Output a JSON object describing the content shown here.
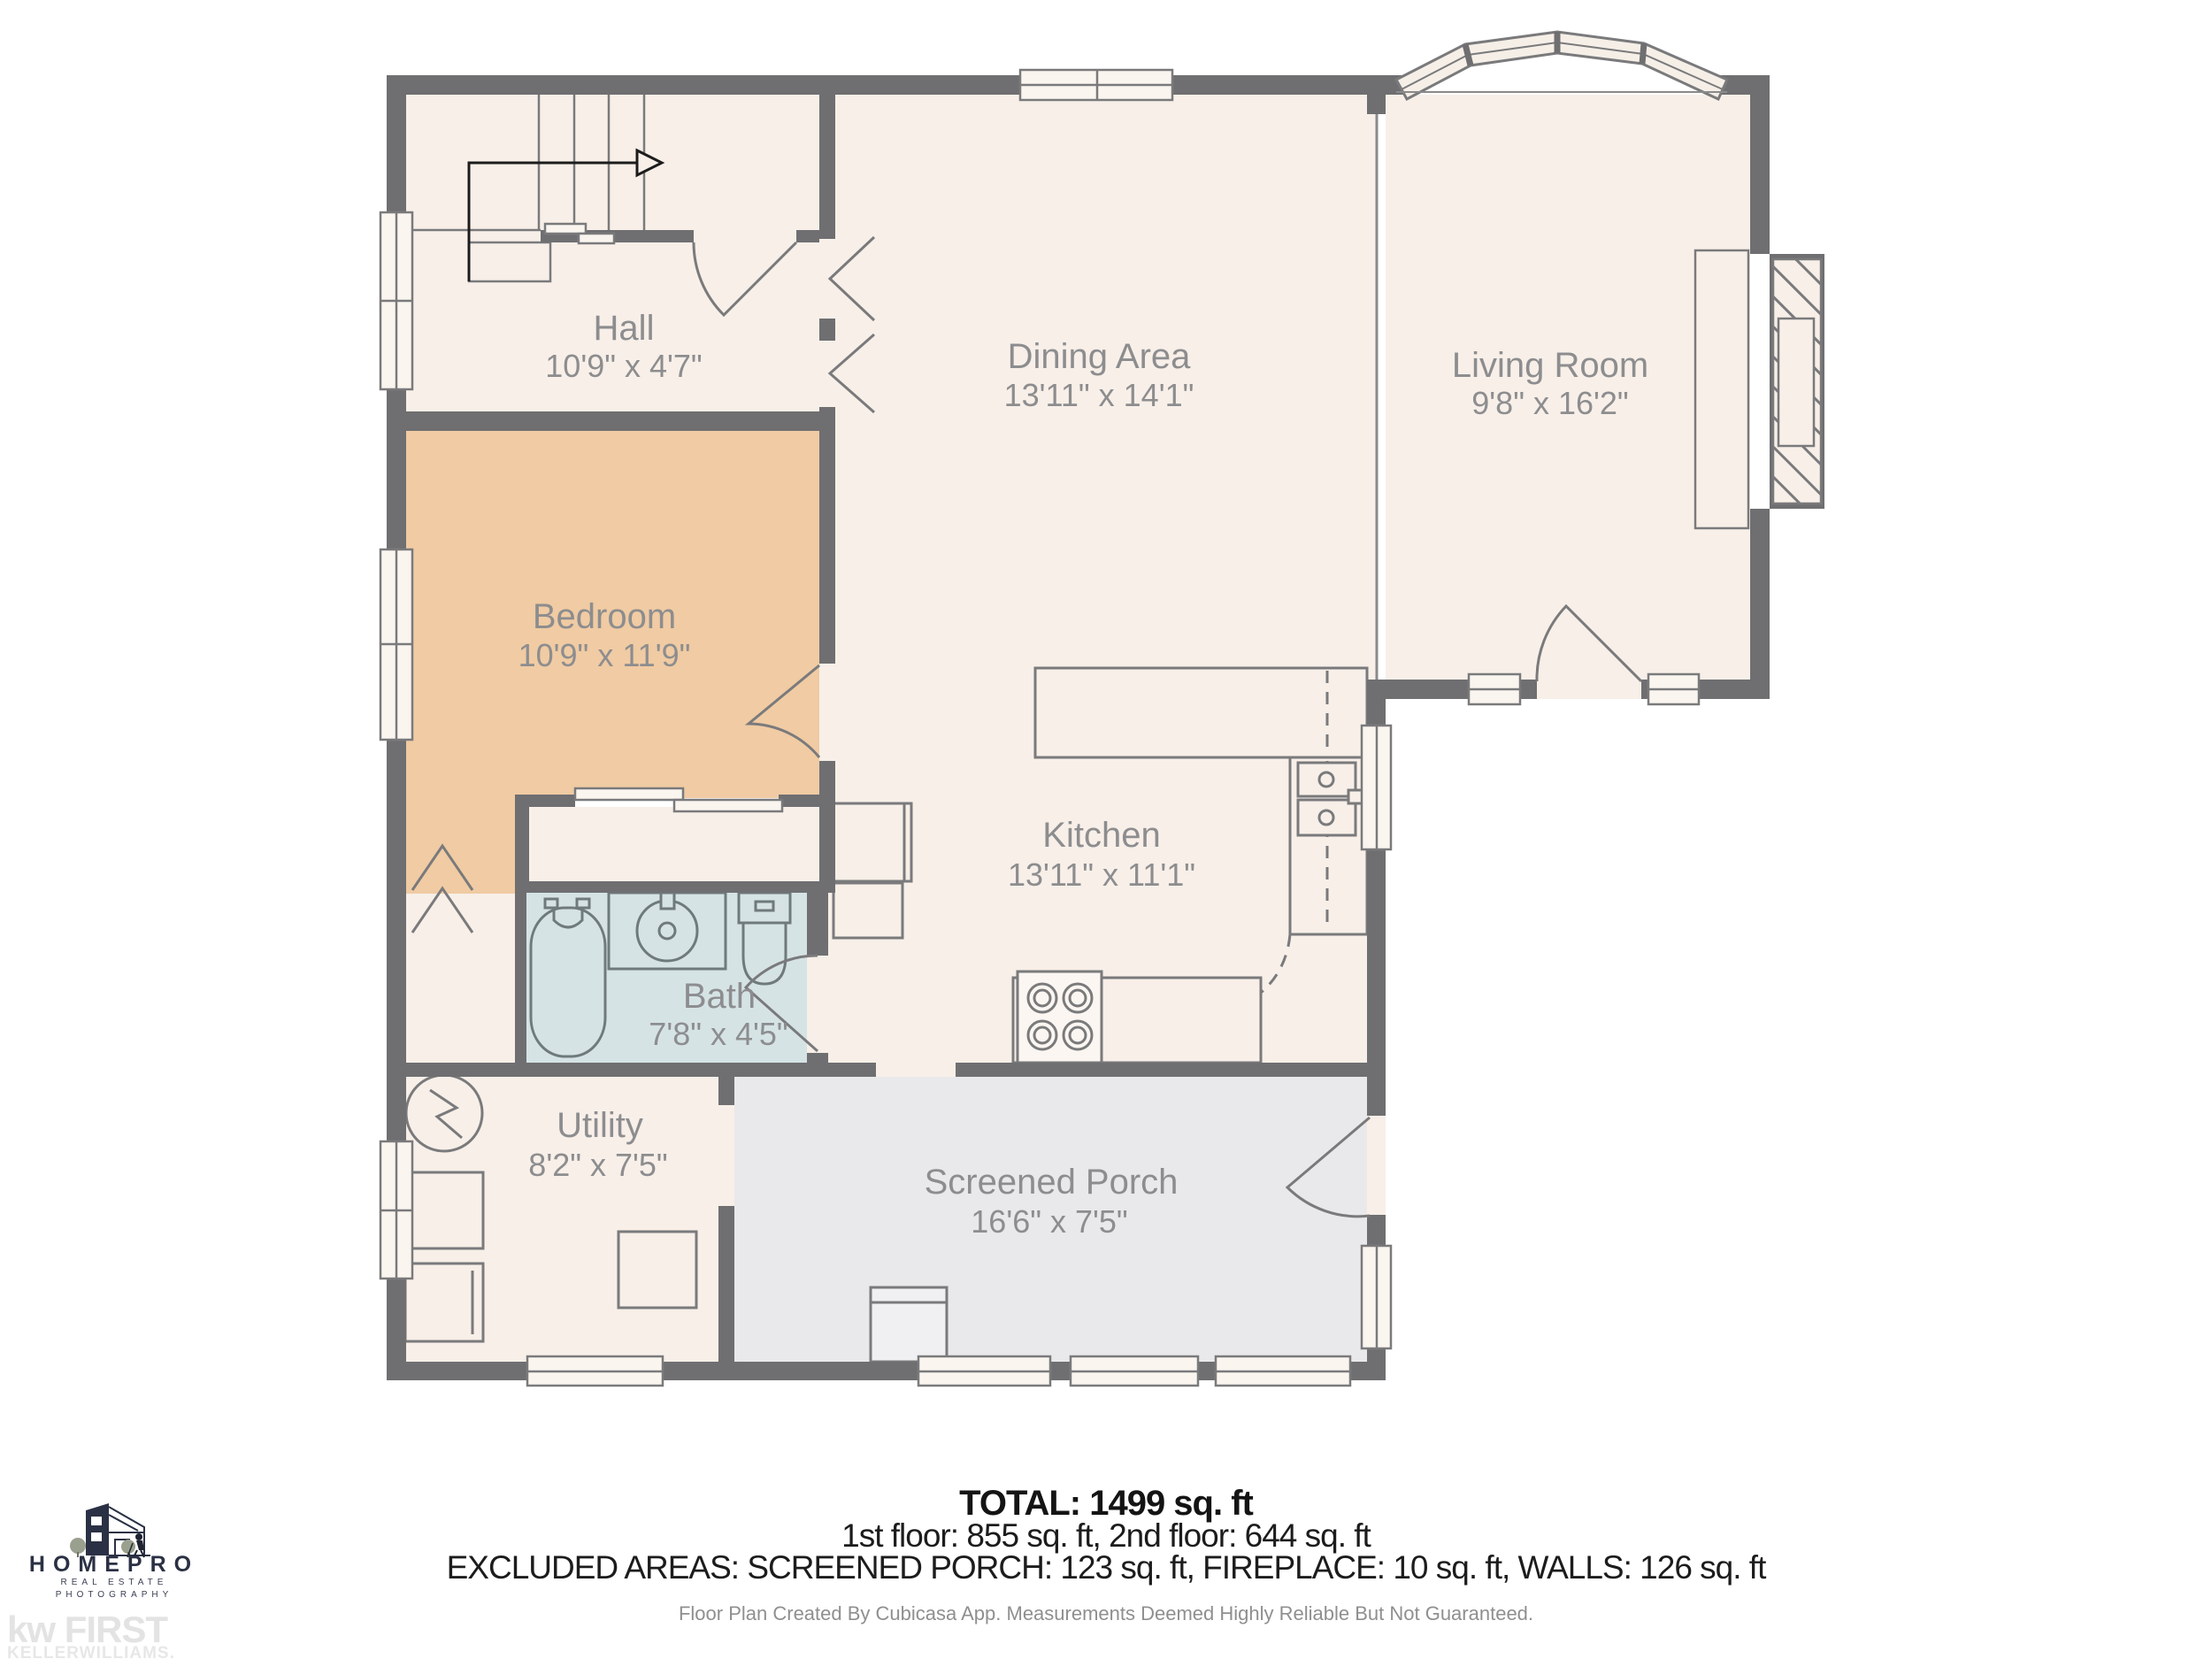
{
  "plan": {
    "rooms": [
      {
        "name": "Hall",
        "dims": "10'9\" x 4'7\""
      },
      {
        "name": "Dining Area",
        "dims": "13'11\" x 14'1\""
      },
      {
        "name": "Living Room",
        "dims": "9'8\" x 16'2\""
      },
      {
        "name": "Bedroom",
        "dims": "10'9\" x 11'9\""
      },
      {
        "name": "Kitchen",
        "dims": "13'11\" x 11'1\""
      },
      {
        "name": "Bath",
        "dims": "7'8\" x 4'5\""
      },
      {
        "name": "Utility",
        "dims": "8'2\" x 7'5\""
      },
      {
        "name": "Screened Porch",
        "dims": "16'6\" x 7'5\""
      }
    ],
    "summary": {
      "total": "TOTAL: 1499 sq. ft",
      "floors": "1st floor: 855 sq. ft, 2nd floor: 644 sq. ft",
      "excluded": "EXCLUDED AREAS: SCREENED PORCH: 123 sq. ft, FIREPLACE: 10 sq. ft, WALLS: 126 sq. ft"
    },
    "footnote": "Floor Plan Created By Cubicasa App. Measurements Deemed Highly Reliable But Not Guaranteed.",
    "logos": {
      "homepro": {
        "name": "HOMEPRO",
        "line1": "REAL ESTATE",
        "line2": "PHOTOGRAPHY"
      },
      "kw": {
        "main": "kw FIRST",
        "sub": "KELLERWILLIAMS."
      }
    },
    "colors": {
      "wall": "#6f6f71",
      "floor": "#f7efe8",
      "bedroom": "#f0cba3",
      "bath": "#d5e3e5",
      "porch": "#e9e9eb",
      "label": "#8d8d8f",
      "line": "#7a7a7c"
    }
  }
}
